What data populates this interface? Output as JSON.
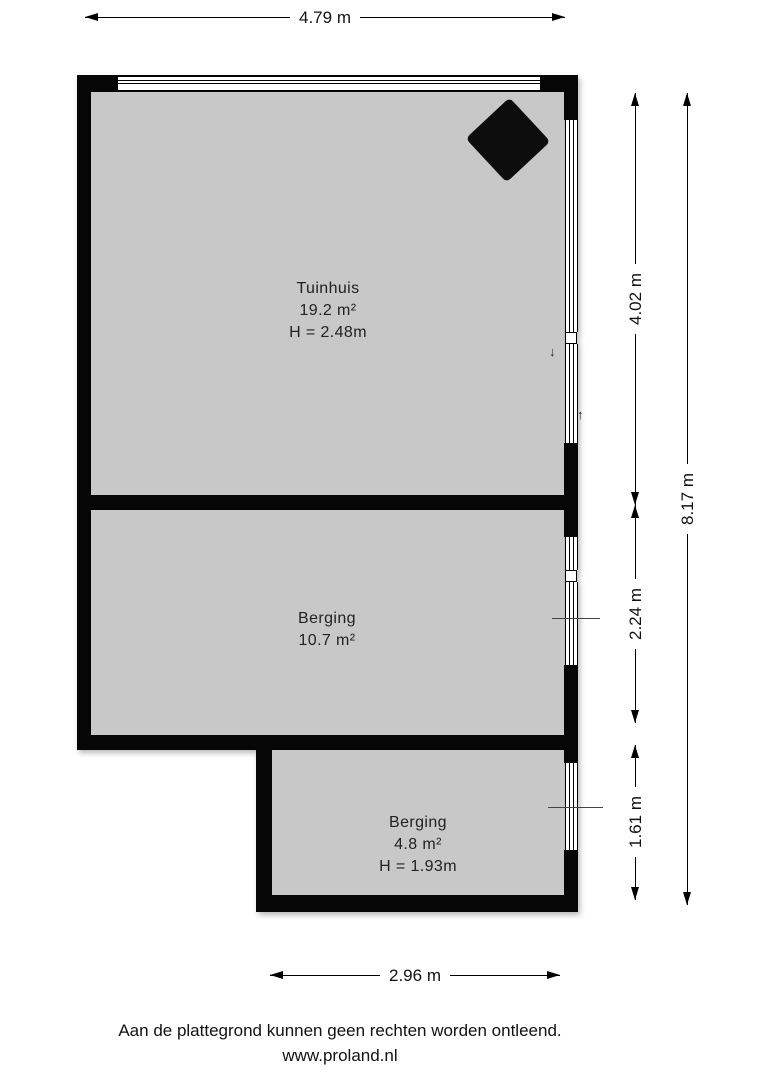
{
  "floorplan": {
    "rooms": [
      {
        "name": "Tuinhuis",
        "area": "19.2 m²",
        "height": "H = 2.48m"
      },
      {
        "name": "Berging",
        "area": "10.7 m²"
      },
      {
        "name": "Berging",
        "area": "4.8 m²",
        "height": "H = 1.93m"
      }
    ],
    "dimensions": {
      "top": "4.79 m",
      "right_inner_top": "4.02 m",
      "right_inner_middle": "2.24 m",
      "right_inner_bottom": "1.61 m",
      "right_outer": "8.17 m",
      "bottom": "2.96 m"
    },
    "icons": {
      "stove": "diamond-stove-symbol",
      "door_arrows": [
        "arrow-down",
        "arrow-up"
      ]
    },
    "colors": {
      "wall": "#060606",
      "floor": "#c8c8c8",
      "background": "#ffffff"
    }
  },
  "footer": {
    "disclaimer": "Aan de plattegrond kunnen geen rechten worden ontleend.",
    "website": "www.proland.nl"
  }
}
